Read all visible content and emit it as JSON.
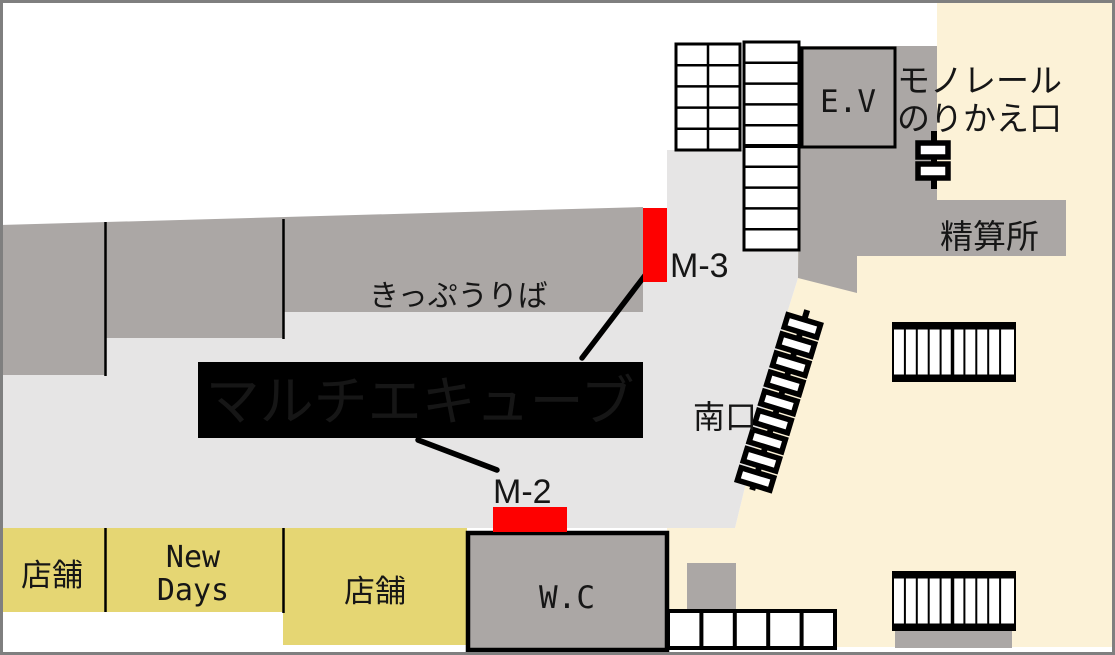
{
  "map": {
    "title_banner": {
      "label": "マルチエキューブ"
    },
    "markers": {
      "m2": "M-2",
      "m3": "M-3"
    },
    "labels": {
      "ticket_office": "きっぷうりば",
      "monorail_line1": "モノレール",
      "monorail_line2": "のりかえ口",
      "fare_adjustment": "精算所",
      "elevator": "E.V",
      "south_exit": "南口",
      "toilet": "W.C",
      "shop_left": "店舗",
      "newdays_line1": "New",
      "newdays_line2": "Days",
      "shop_right": "店舗"
    },
    "colors": {
      "beige": "#fcf2d7",
      "concourse_gray": "#e6e5e5",
      "structure_gray": "#aba7a5",
      "yellow": "#e5d673",
      "red": "#fe0000",
      "black": "#000000",
      "white": "#ffffff",
      "frame_gray": "#7f7f7f"
    }
  }
}
